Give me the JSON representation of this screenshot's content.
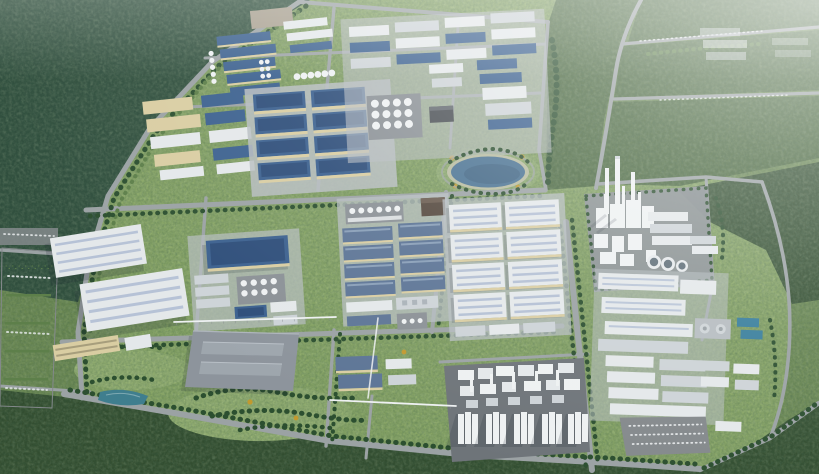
{
  "meta": {
    "title": "Aerial bird's-eye 3D rendering of an industrial park master plan surrounded by forest",
    "view": "high-angle aerial perspective, daytime, haze toward top-right",
    "visible_text": "none"
  },
  "scene": {
    "regions": [
      {
        "id": "forest-northwest",
        "label": "Dense dark forest",
        "position": "top-left"
      },
      {
        "id": "greenfield-east",
        "label": "Woodland and green fields crossed by access roads with parked cars",
        "position": "right / top-right"
      },
      {
        "id": "forest-belt-south",
        "label": "Forest belt",
        "position": "bottom edge"
      },
      {
        "id": "factory-cluster-northwest",
        "label": "Rows of small blue-roof factories with tank columns and gravel yard",
        "position": "upper-left of park"
      },
      {
        "id": "blue-factory-block",
        "label": "Grid of large blue-roof factory halls with beige walls",
        "position": "top-center"
      },
      {
        "id": "mixed-factory-cluster-north",
        "label": "Dense mixed white/blue factory rows with tank farm and dark utility building",
        "position": "top-center-right"
      },
      {
        "id": "lake-park",
        "label": "Landscaped lake with waterfront promenade and autumn trees",
        "position": "center, right of factories"
      },
      {
        "id": "warehouse-cluster-west",
        "label": "Two large white ridged logistics warehouses with office block",
        "position": "center-left"
      },
      {
        "id": "parking-lot-west",
        "label": "Striped surface parking lot",
        "position": "left edge"
      },
      {
        "id": "mixed-cluster-center-west",
        "label": "Blue warehouse, gray sheds and white tank rows",
        "position": "center-left"
      },
      {
        "id": "slate-factory-block-center",
        "label": "Grid of slate-blue roof factories with tank row",
        "position": "center"
      },
      {
        "id": "white-warehouse-block-center",
        "label": "Grid of large white skylit warehouses",
        "position": "center-right of middle band"
      },
      {
        "id": "gray-flat-hall",
        "label": "Very large flat gray hall with two roof ridges",
        "position": "bottom-center-left"
      },
      {
        "id": "retention-pond",
        "label": "Small teal retention pond",
        "position": "bottom-left"
      },
      {
        "id": "process-plant-south",
        "label": "Process plant: dense white units and five silo groups on dark pad",
        "position": "bottom-center"
      },
      {
        "id": "process-plant-east",
        "label": "Chemical plant with three tall chimneys, towers and cooling towers",
        "position": "center-right"
      },
      {
        "id": "warehouse-district-east",
        "label": "Long white warehouse rows, treatment pools, clarifiers and parking",
        "position": "lower-right"
      },
      {
        "id": "tree-lined-avenue",
        "label": "Tree-lined north-south avenue",
        "position": "right-center"
      },
      {
        "id": "pipe-rack",
        "label": "Elevated white pipe racks linking plants",
        "position": "center-south"
      },
      {
        "id": "lawn-south",
        "label": "Open lawn with scattered green and autumn trees",
        "position": "bottom-center-left"
      }
    ],
    "counts": {
      "tall_chimneys": 3,
      "cooling_towers": 3,
      "silo_groups": 5,
      "lakes": 1,
      "ponds": 1,
      "treatment_pools": 2,
      "parking_lots": 3
    }
  },
  "colors": {
    "field_green": "#6d8a52",
    "forest_teal": "#2e4c3c",
    "forest_mid": "#4a673c",
    "forest_dark": "#314b2d",
    "park_green": "#8aa765",
    "park_light": "#97b272",
    "road": "#9ba2a4",
    "road_dark": "#84898c",
    "pad": "#b7bdc1",
    "plant_pad": "#6e7479",
    "plant_pad2": "#8b9196",
    "roof_blue": "#3c618f",
    "roof_blue_dark": "#2e4e7a",
    "roof_slate": "#5d7596",
    "roof_white": "#e4e8ea",
    "roof_light": "#cdd3d7",
    "skylight": "#aebbd2",
    "wall_beige": "#d9cda2",
    "tank_white": "#eef1f2",
    "big_roof": "#8d949c",
    "big_roof_ridge": "#9ea6ad",
    "lake": "#4a7292",
    "lake_deep": "#3c5f7d",
    "pond": "#3f7e8e",
    "pool": "#3a7f9d",
    "tree": "#2c4f30",
    "tree_light": "#5d7f4a",
    "tree_yellow": "#c1992f",
    "car": "#e9eced",
    "rack": "#eef1f2",
    "shadow": "rgba(25,35,48,0.38)"
  }
}
